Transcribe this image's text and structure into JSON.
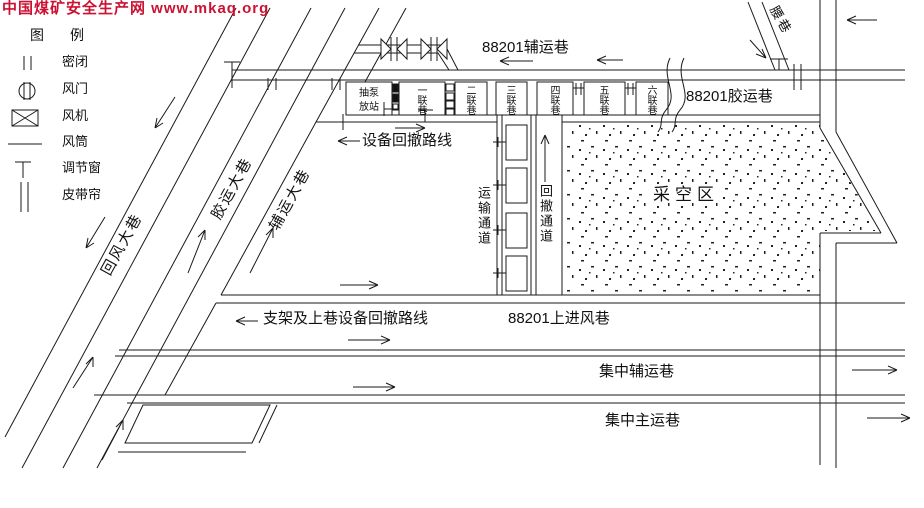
{
  "watermark": {
    "text": "中国煤矿安全生产网 www.mkaq.org",
    "color": "#cc1133"
  },
  "legend": {
    "title": "图　例",
    "items": [
      {
        "label": "密闭",
        "icon": "seal-icon"
      },
      {
        "label": "风门",
        "icon": "air-door-icon"
      },
      {
        "label": "风机",
        "icon": "fan-icon"
      },
      {
        "label": "风筒",
        "icon": "air-duct-icon"
      },
      {
        "label": "调节窗",
        "icon": "regulator-window-icon"
      },
      {
        "label": "皮带帘",
        "icon": "belt-curtain-icon"
      }
    ]
  },
  "roadways": {
    "main_return": "回风大巷",
    "main_belt": "胶运大巷",
    "main_aux": "辅运大巷",
    "waist": "腰巷",
    "aux_88201": "88201辅运巷",
    "belt_88201": "88201胶运巷",
    "intake_88201": "88201上进风巷",
    "central_aux": "集中辅运巷",
    "central_main": "集中主运巷"
  },
  "rooms": {
    "pump_station_line1": "抽泵",
    "pump_station_line2": "放站",
    "lianxiang": [
      "一联巷",
      "二联巷",
      "三联巷",
      "四联巷",
      "五联巷",
      "六联巷"
    ]
  },
  "channels": {
    "transport": "运输通道",
    "retreat": "回撤通道"
  },
  "areas": {
    "goaf": "采空区"
  },
  "routes": {
    "equipment": "设备回撤路线",
    "support": "支架及上巷设备回撤路线"
  },
  "colors": {
    "line": "#1a1a1a",
    "background": "#ffffff",
    "watermark": "#cc1133"
  }
}
